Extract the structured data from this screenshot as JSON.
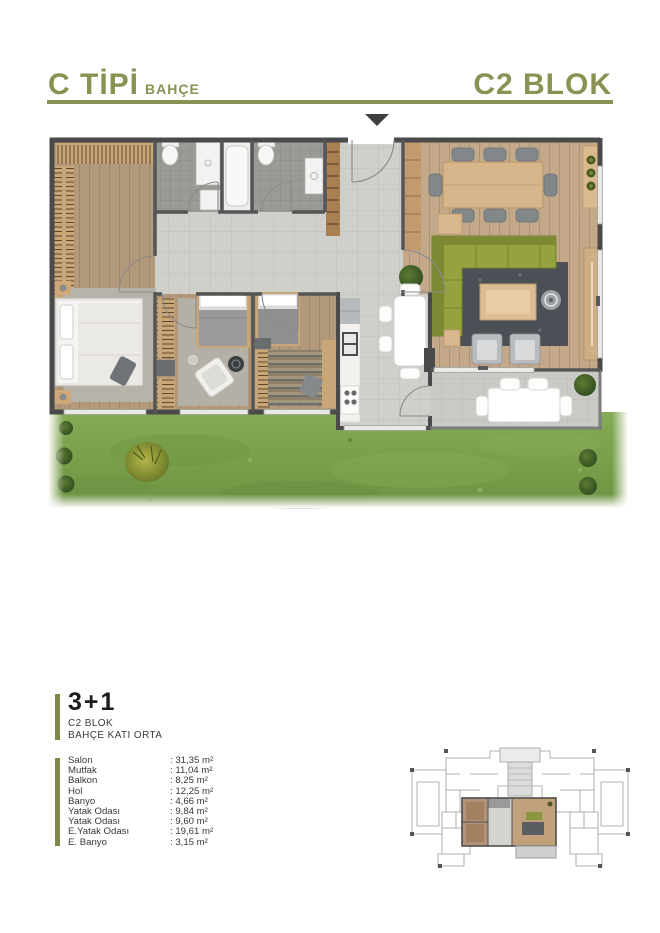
{
  "palette": {
    "accent": "#8a9152",
    "accent_bar": "#7f8748",
    "wall": "#4a4a4a",
    "tile": "#cfcfcb",
    "bath_tile": "#9a9a97",
    "wood_floor": "#b3997b",
    "living_floor": "#c3a98a",
    "sofa_olive": "#95a23e",
    "garden_green": "#7aa14d",
    "text_dark": "#383838"
  },
  "header": {
    "type_label": "C TİPİ",
    "type_sub": "BAHÇE",
    "block_label": "C2 BLOK"
  },
  "plan": {
    "entrance_marker": "entrance-arrow-icon"
  },
  "unit": {
    "layout_label": "3+1",
    "block": "C2 BLOK",
    "floor": "BAHÇE KATI ORTA",
    "areas": [
      {
        "label": "Salon",
        "value": ": 31,35 m²"
      },
      {
        "label": "Mutfak",
        "value": ": 11,04 m²"
      },
      {
        "label": "Balkon",
        "value": ": 8,25 m²"
      },
      {
        "label": "Hol",
        "value": ": 12,25 m²"
      },
      {
        "label": "Banyo",
        "value": ": 4,66 m²"
      },
      {
        "label": "Yatak Odası",
        "value": ": 9,84 m²"
      },
      {
        "label": "Yatak Odası",
        "value": ": 9,60 m²"
      },
      {
        "label": "E.Yatak Odası",
        "value": ": 19,61 m²"
      },
      {
        "label": "E. Banyo",
        "value": ": 3,15 m²"
      }
    ]
  }
}
